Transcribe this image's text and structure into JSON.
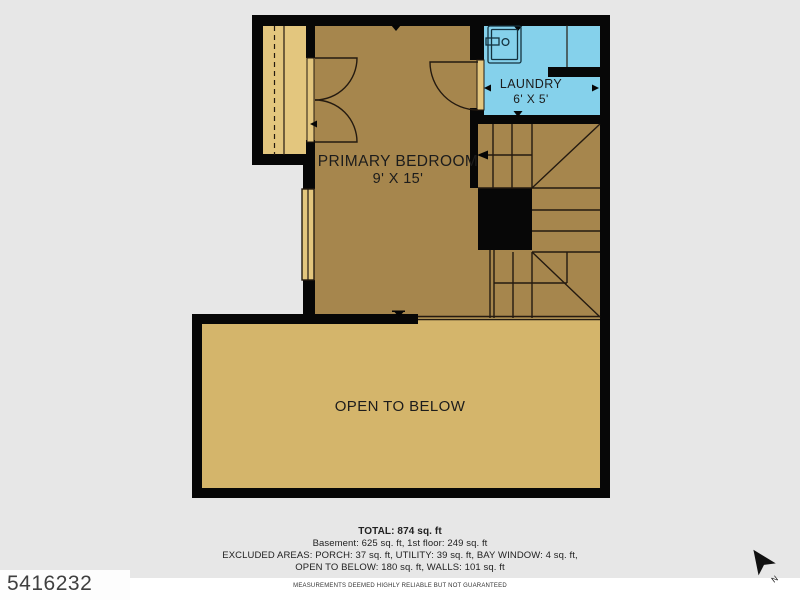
{
  "plan": {
    "rooms": [
      {
        "name": "PRIMARY BEDROOM",
        "dims": "9' X 15'"
      },
      {
        "name": "LAUNDRY",
        "dims": "6' X 5'"
      },
      {
        "name": "OPEN TO BELOW",
        "dims": ""
      }
    ],
    "north_label": "N"
  },
  "summary": {
    "total": "TOTAL: 874 sq. ft",
    "floors": "Basement: 625 sq. ft, 1st floor: 249 sq. ft",
    "excluded_1": "EXCLUDED AREAS: PORCH: 37 sq. ft, UTILITY: 39 sq. ft, BAY WINDOW: 4 sq. ft,",
    "excluded_2": "OPEN TO BELOW: 180 sq. ft, WALLS: 101 sq. ft",
    "disclaimer": "MEASUREMENTS DEEMED HIGHLY RELIABLE BUT NOT GUARANTEED"
  },
  "listing_id": "5416232",
  "colors": {
    "background": "#e7e7e7",
    "wall": "#070707",
    "bedroom": "#a6864d",
    "open_below": "#d4b56b",
    "closet": "#e3c67e",
    "laundry": "#85d1eb",
    "line": "#241a10",
    "tick": "#050505",
    "washer_line": "#14323f"
  }
}
